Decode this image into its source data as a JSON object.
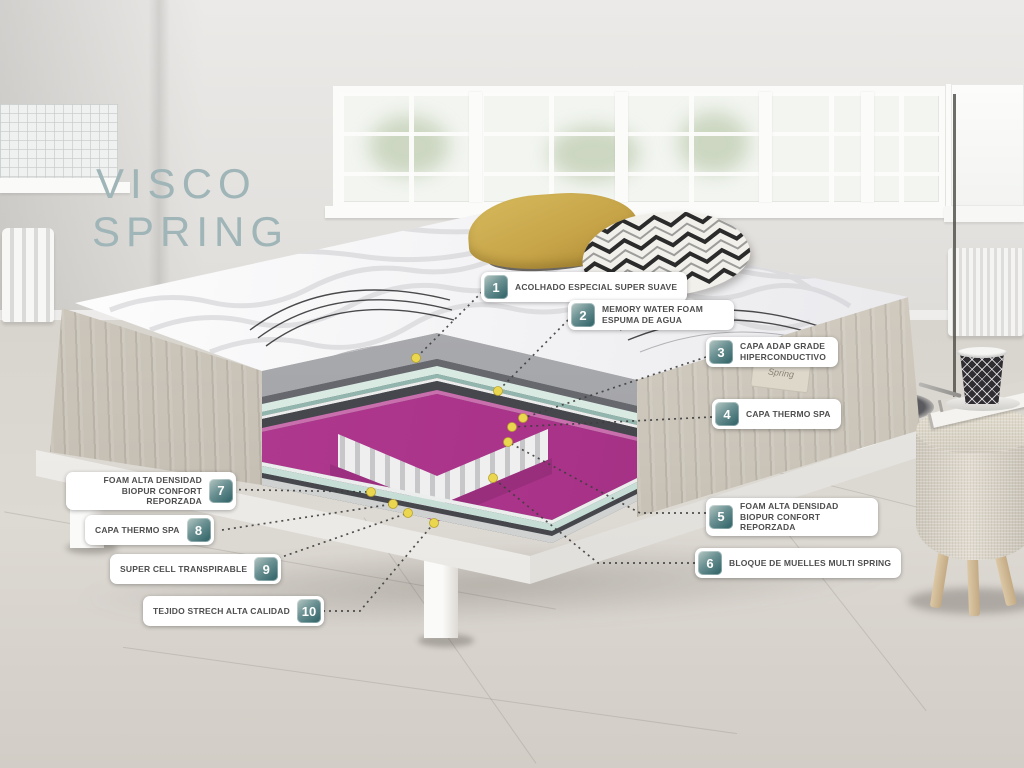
{
  "title": {
    "line1": "VISCO",
    "line2": "SPRING"
  },
  "callouts": [
    {
      "num": "1",
      "text": "ACOLHADO ESPECIAL SUPER SUAVE"
    },
    {
      "num": "2",
      "text": "MEMORY WATER FOAM ESPUMA DE AGUA"
    },
    {
      "num": "3",
      "text": "CAPA ADAP GRADE HIPERCONDUCTIVO"
    },
    {
      "num": "4",
      "text": "CAPA THERMO SPA"
    },
    {
      "num": "5",
      "text": "FOAM ALTA DENSIDAD BIOPUR CONFORT REPORZADA"
    },
    {
      "num": "6",
      "text": "BLOQUE DE MUELLES MULTI SPRING"
    },
    {
      "num": "7",
      "text": "FOAM ALTA DENSIDAD BIOPUR CONFORT REPORZADA"
    },
    {
      "num": "8",
      "text": "CAPA THERMO SPA"
    },
    {
      "num": "9",
      "text": "SUPER CELL TRANSPIRABLE"
    },
    {
      "num": "10",
      "text": "TEJIDO STRECH ALTA CALIDAD"
    }
  ],
  "brand_tag": "Spring",
  "colors": {
    "badge_teal_dark": "#2b5f63",
    "badge_teal_light": "#b6c8c4",
    "title_teal": "#9fb5b7",
    "layer_magenta": "#b53d94",
    "layer_mint": "#d9eae3",
    "layer_gray": "#a8a9ad",
    "dot_yellow": "#ead64f",
    "pillow_yellow": "#c6a347"
  }
}
